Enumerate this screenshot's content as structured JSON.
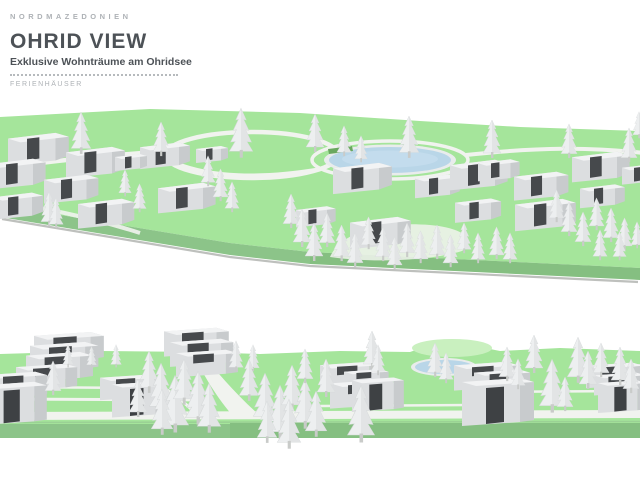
{
  "header": {
    "eyebrow": "NORDMAZEDONIEN",
    "title": "OHRID VIEW",
    "subtitle": "Exklusive Wohnträume am Ohridsee",
    "tagline": "FERIENHÄUSER"
  },
  "palette": {
    "background": "#ffffff",
    "text_dark": "#4d5257",
    "text_muted": "#aeb2b6",
    "dot_color": "#b6babd",
    "terrain_top": "#a5e59b",
    "terrain_side": "#8cc489",
    "terrain_side_dark": "#85bf81",
    "terrain_shadow": "#7d827c",
    "terrain_highlight": "#c9f0bf",
    "path": "#f1f3ef",
    "pond": "#b9d6e8",
    "pond_rim": "#e9ecec",
    "house_front": "#dcdee0",
    "house_side": "#c8cbcd",
    "house_roof": "#f2f3f4",
    "house_panel": "#46494c",
    "house_door": "#3e4144",
    "tree_fill": "#edeff0",
    "tree_shade": "#dfe2e3",
    "tree_stroke": "#d5d8d9",
    "trunk": "#c9cbc9",
    "hedge": "#6aa85f"
  }
}
